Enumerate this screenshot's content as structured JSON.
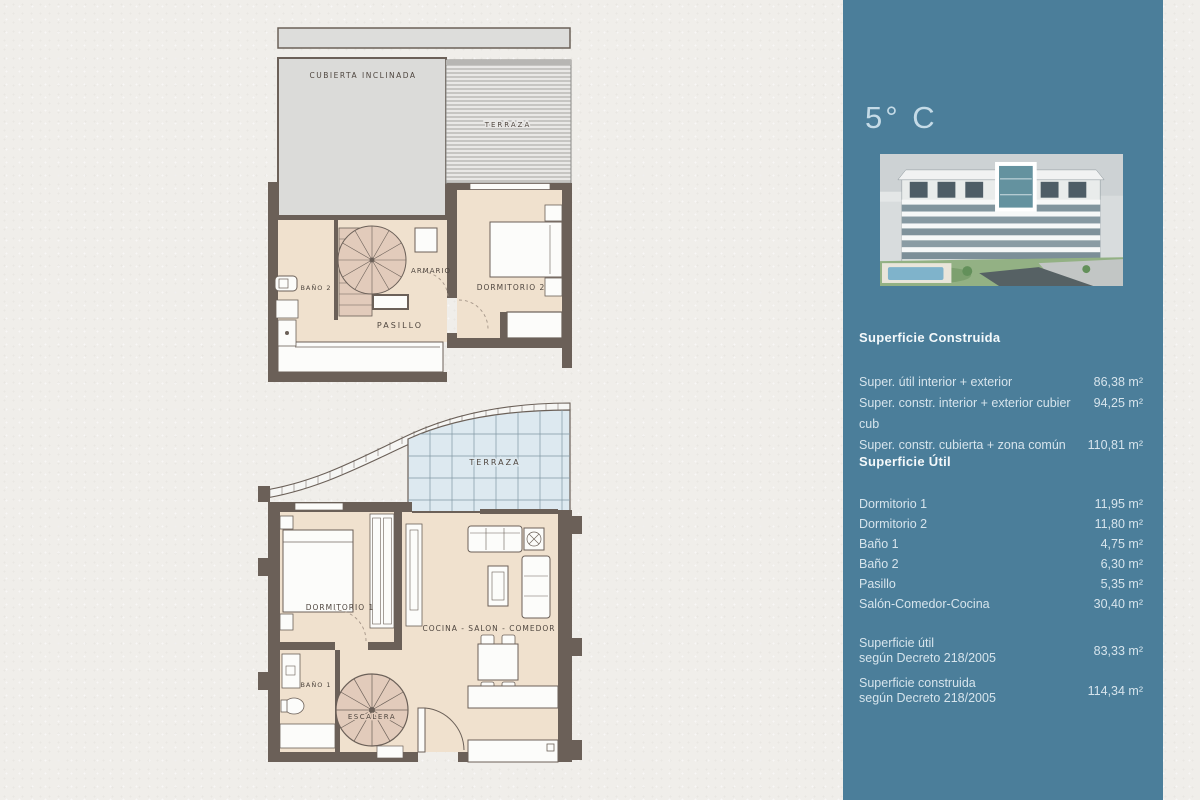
{
  "page": {
    "background": "#f0eeea"
  },
  "colors": {
    "sidebar_bg": "#4b7e9a",
    "wall": "#6b6058",
    "room_fill": "#f0e1ce",
    "stair_fill": "#e2cbbb",
    "glass_fill": "#dde9f0",
    "highlight_teal": "#64929f"
  },
  "sidebar": {
    "title": "5° C",
    "construida": {
      "heading": "Superficie Construida",
      "rows": [
        {
          "label": "Super. útil interior + exterior",
          "value": "86,38 m²"
        },
        {
          "label": "Super. constr. interior + exterior cubier cub",
          "value": "94,25 m²"
        },
        {
          "label": "Super. constr. cubierta + zona común",
          "value": "110,81 m²"
        }
      ]
    },
    "util": {
      "heading": "Superficie Útil",
      "rows": [
        {
          "label": "Dormitorio 1",
          "value": "11,95 m²"
        },
        {
          "label": "Dormitorio 2",
          "value": "11,80 m²"
        },
        {
          "label": "Baño 1",
          "value": "4,75 m²"
        },
        {
          "label": "Baño 2",
          "value": "6,30 m²"
        },
        {
          "label": "Pasillo",
          "value": "5,35 m²"
        },
        {
          "label": "Salón-Comedor-Cocina",
          "value": "30,40 m²"
        }
      ]
    },
    "decreto": [
      {
        "line1": "Superficie útil",
        "line2": "según Decreto 218/2005",
        "value": "83,33 m²"
      },
      {
        "line1": "Superficie construida",
        "line2": "según Decreto 218/2005",
        "value": "114,34 m²"
      }
    ]
  },
  "plans": {
    "upper": {
      "labels": {
        "cubierta": "CUBIERTA INCLINADA",
        "terraza": "TERRAZA",
        "bano2": "BAÑO 2",
        "armario": "ARMARIO",
        "pasillo": "PASILLO",
        "dormitorio2": "DORMITORIO 2"
      }
    },
    "lower": {
      "labels": {
        "terraza": "TERRAZA",
        "dormitorio1": "DORMITORIO 1",
        "cocina": "COCINA - SALON - COMEDOR",
        "bano1": "BAÑO 1",
        "escalera": "ESCALERA"
      }
    }
  }
}
